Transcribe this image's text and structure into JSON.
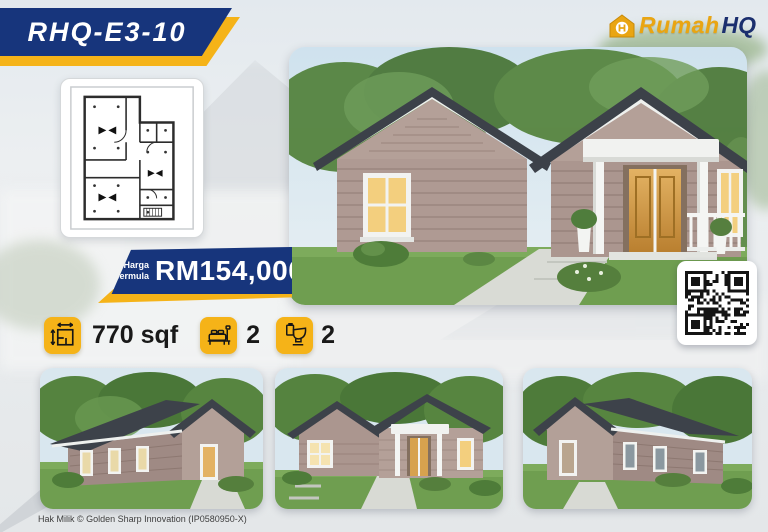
{
  "model_code": "RHQ-E3-10",
  "brand": {
    "word1": "Rumah",
    "word2": "HQ",
    "logo_icon": "house-monogram-icon"
  },
  "price": {
    "label1": "Harga",
    "label2": "bermula",
    "value": "RM154,000"
  },
  "specs": {
    "area": {
      "icon": "floorplan-measure-icon",
      "value": "770 sqf"
    },
    "bedrooms": {
      "icon": "bed-icon",
      "value": "2"
    },
    "bathrooms": {
      "icon": "toilet-icon",
      "value": "2"
    }
  },
  "images": {
    "floor_plan": "floor-plan-drawing",
    "main_render": "house-3d-render-front",
    "thumb1": "house-3d-render-side-left",
    "thumb2": "house-3d-render-front-small",
    "thumb3": "house-3d-render-side-right",
    "qr": "qr-code"
  },
  "footer": {
    "copyright": "Hak Milik © Golden Sharp Innovation (IP0580950-X)"
  },
  "colors": {
    "navy": "#17357C",
    "gold": "#F5B318",
    "roof": "#3C4149",
    "siding": "#AF9A93",
    "lawn": "#6F9E50"
  }
}
